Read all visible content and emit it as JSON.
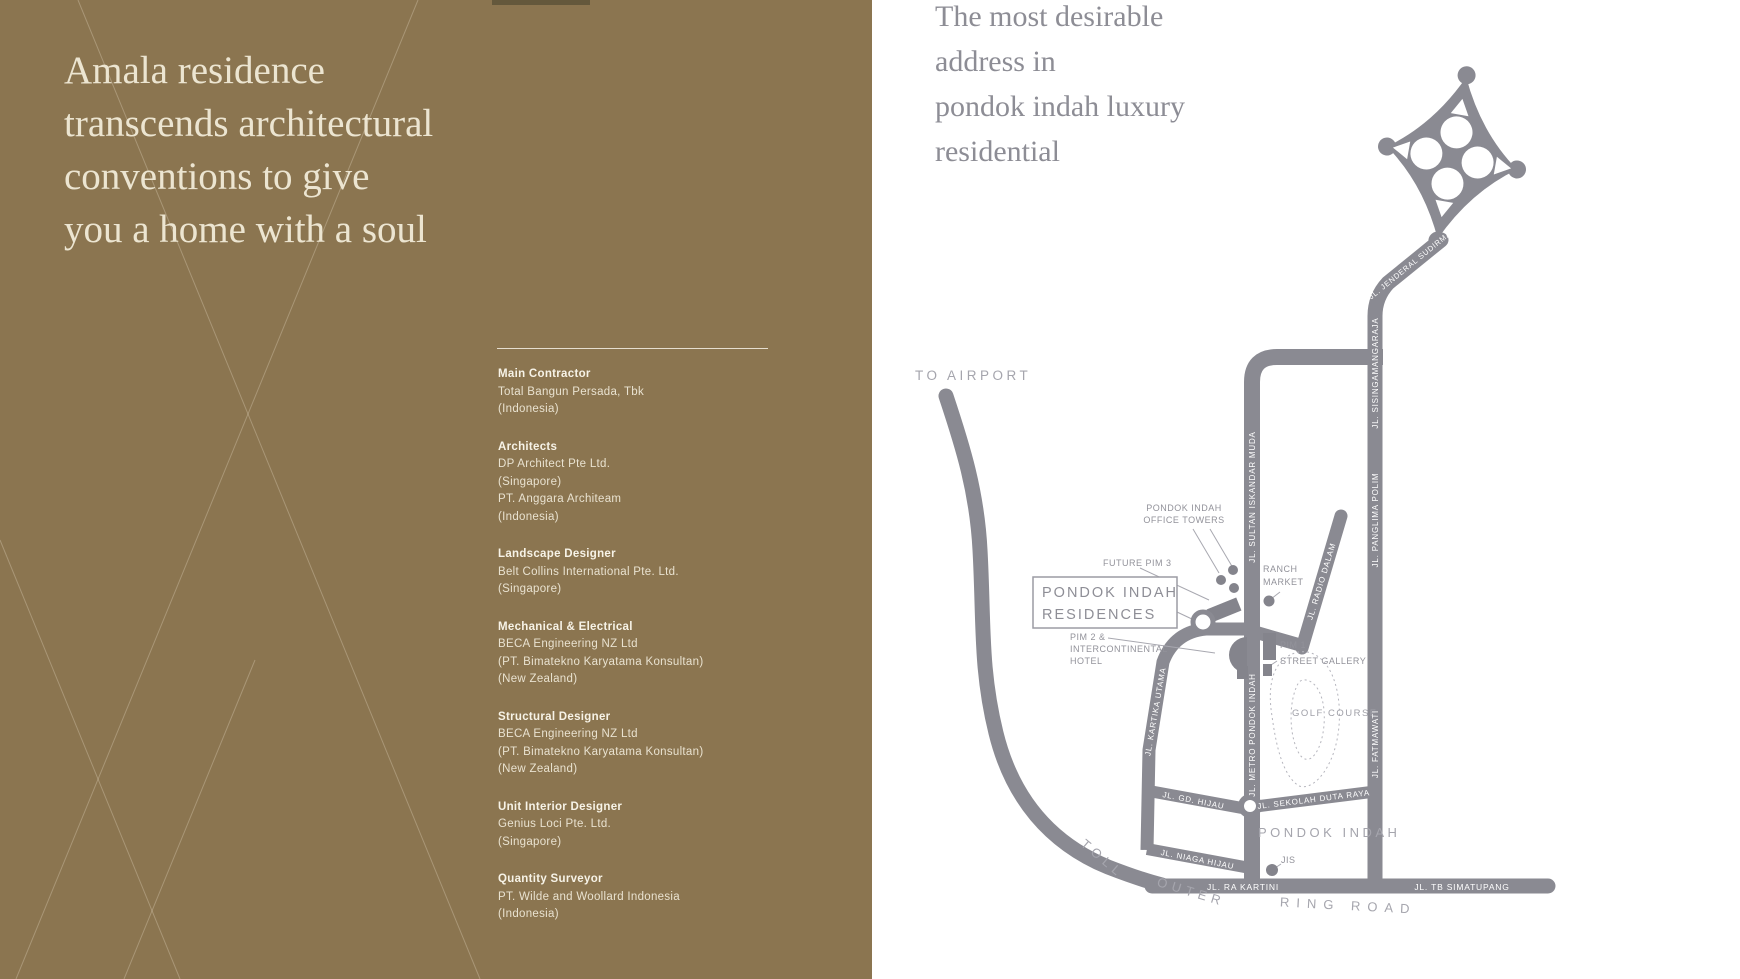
{
  "left_panel": {
    "headline_lines": [
      "Amala residence",
      "transcends architectural",
      "conventions to give",
      "you a home with a soul"
    ],
    "credits": [
      {
        "label": "Main Contractor",
        "lines": [
          "Total Bangun Persada, Tbk",
          "(Indonesia)"
        ]
      },
      {
        "label": "Architects",
        "lines": [
          "DP Architect Pte Ltd.",
          "(Singapore)",
          "PT. Anggara Architeam",
          "(Indonesia)"
        ]
      },
      {
        "label": "Landscape Designer",
        "lines": [
          "Belt Collins International Pte. Ltd.",
          "(Singapore)"
        ]
      },
      {
        "label": "Mechanical & Electrical",
        "lines": [
          "BECA Engineering NZ Ltd",
          "(PT. Bimatekno Karyatama Konsultan)",
          "(New Zealand)"
        ]
      },
      {
        "label": "Structural Designer",
        "lines": [
          "BECA Engineering NZ Ltd",
          "(PT. Bimatekno Karyatama Konsultan)",
          "(New Zealand)"
        ]
      },
      {
        "label": "Unit Interior Designer",
        "lines": [
          "Genius Loci Pte. Ltd.",
          "(Singapore)"
        ]
      },
      {
        "label": "Quantity Surveyor",
        "lines": [
          "PT. Wilde and Woollard Indonesia",
          "(Indonesia)"
        ]
      }
    ]
  },
  "right_panel": {
    "headline_lines": [
      "The most desirable",
      "address in",
      "pondok indah luxury",
      "residential"
    ]
  },
  "map": {
    "labels": {
      "to_airport": "TO AIRPORT",
      "office_towers_1": "PONDOK INDAH",
      "office_towers_2": "OFFICE TOWERS",
      "future_pim3": "FUTURE PIM 3",
      "residences_1": "PONDOK INDAH",
      "residences_2": "RESIDENCES",
      "pim2_line1": "PIM 2 &",
      "pim2_line2": "INTERCONTINENTAL",
      "pim2_line3": "HOTEL",
      "ranch_1": "RANCH",
      "ranch_2": "MARKET",
      "pim1": "PIM 1",
      "street_gallery": "STREET GALLERY",
      "golf": "GOLF COURSE",
      "area_pondok_indah": "PONDOK INDAH",
      "jis": "JIS",
      "toll_jorr": "TOLL JORR",
      "toll_outer_1": "TOLL",
      "toll_outer_2": "OUTER",
      "toll_outer_3": "RING ROAD"
    },
    "roads": {
      "sudirman": "JL. JENDERAL SUDIRMAN",
      "sisingamangaraja": "JL. SISINGAMANGARAJA",
      "panglima_polim": "JL. PANGLIMA POLIM",
      "fatmawati": "JL. FATMAWATI",
      "sultan_iskandar_muda": "JL. SULTAN ISKANDAR MUDA",
      "metro_pondok_indah": "JL. METRO PONDOK INDAH",
      "radio_dalam": "JL. RADIO DALAM",
      "kartika_utama": "JL. KARTIKA UTAMA",
      "gd_hijau": "JL. GD. HIJAU",
      "niaga_hijau": "JL. NIAGA HIJAU",
      "sekolah_duta_raya": "JL. SEKOLAH DUTA RAYA",
      "ra_kartini": "JL. RA KARTINI",
      "tb_simatupang": "JL. TB SIMATUPANG"
    },
    "colors": {
      "panel_brown": "#8b7550",
      "cream": "#ece5d1",
      "road_gray": "#8a8a92",
      "label_gray": "#92929a",
      "light_gray": "#a5a5ad",
      "headline_gray": "#8d8d95"
    }
  }
}
